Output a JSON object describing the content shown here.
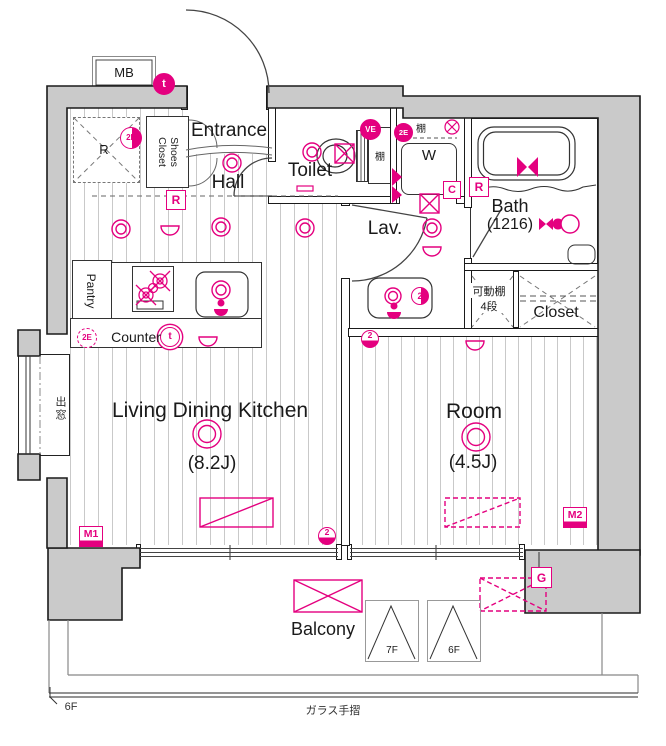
{
  "rooms": {
    "entrance": "Entrance",
    "hall": "Hall",
    "toilet": "Toilet",
    "shoes_closet_line1": "Shoes",
    "shoes_closet_line2": "Closet",
    "lav": "Lav.",
    "bath": "Bath",
    "bath_size": "(1216)",
    "ldk": "Living Dining Kitchen",
    "ldk_size": "(8.2J)",
    "room": "Room",
    "room_size": "(4.5J)",
    "closet": "Closet",
    "pantry": "Pantry",
    "counter": "Counter",
    "balcony": "Balcony",
    "washer": "W",
    "meter_box": "MB",
    "bay_window": "出窓",
    "shelf_toilet": "棚",
    "shelf_washer": "棚",
    "adjustable_shelf": "可動棚",
    "adjustable_shelf_steps": "4段",
    "refrigerator": "R"
  },
  "markers": {
    "t": "t",
    "e2": "2E",
    "ve": "VE",
    "r": "R",
    "c": "C",
    "m1": "M1",
    "m2": "M2",
    "g": "G",
    "n2": "2"
  },
  "hatch": {
    "upper": "7F",
    "lower": "6F"
  },
  "footer": {
    "floor_level": "6F",
    "glass_rail": "ガラス手摺"
  },
  "colors": {
    "annotation": "#e4007f",
    "wall_fill": "#cacaca",
    "line": "#333333"
  }
}
